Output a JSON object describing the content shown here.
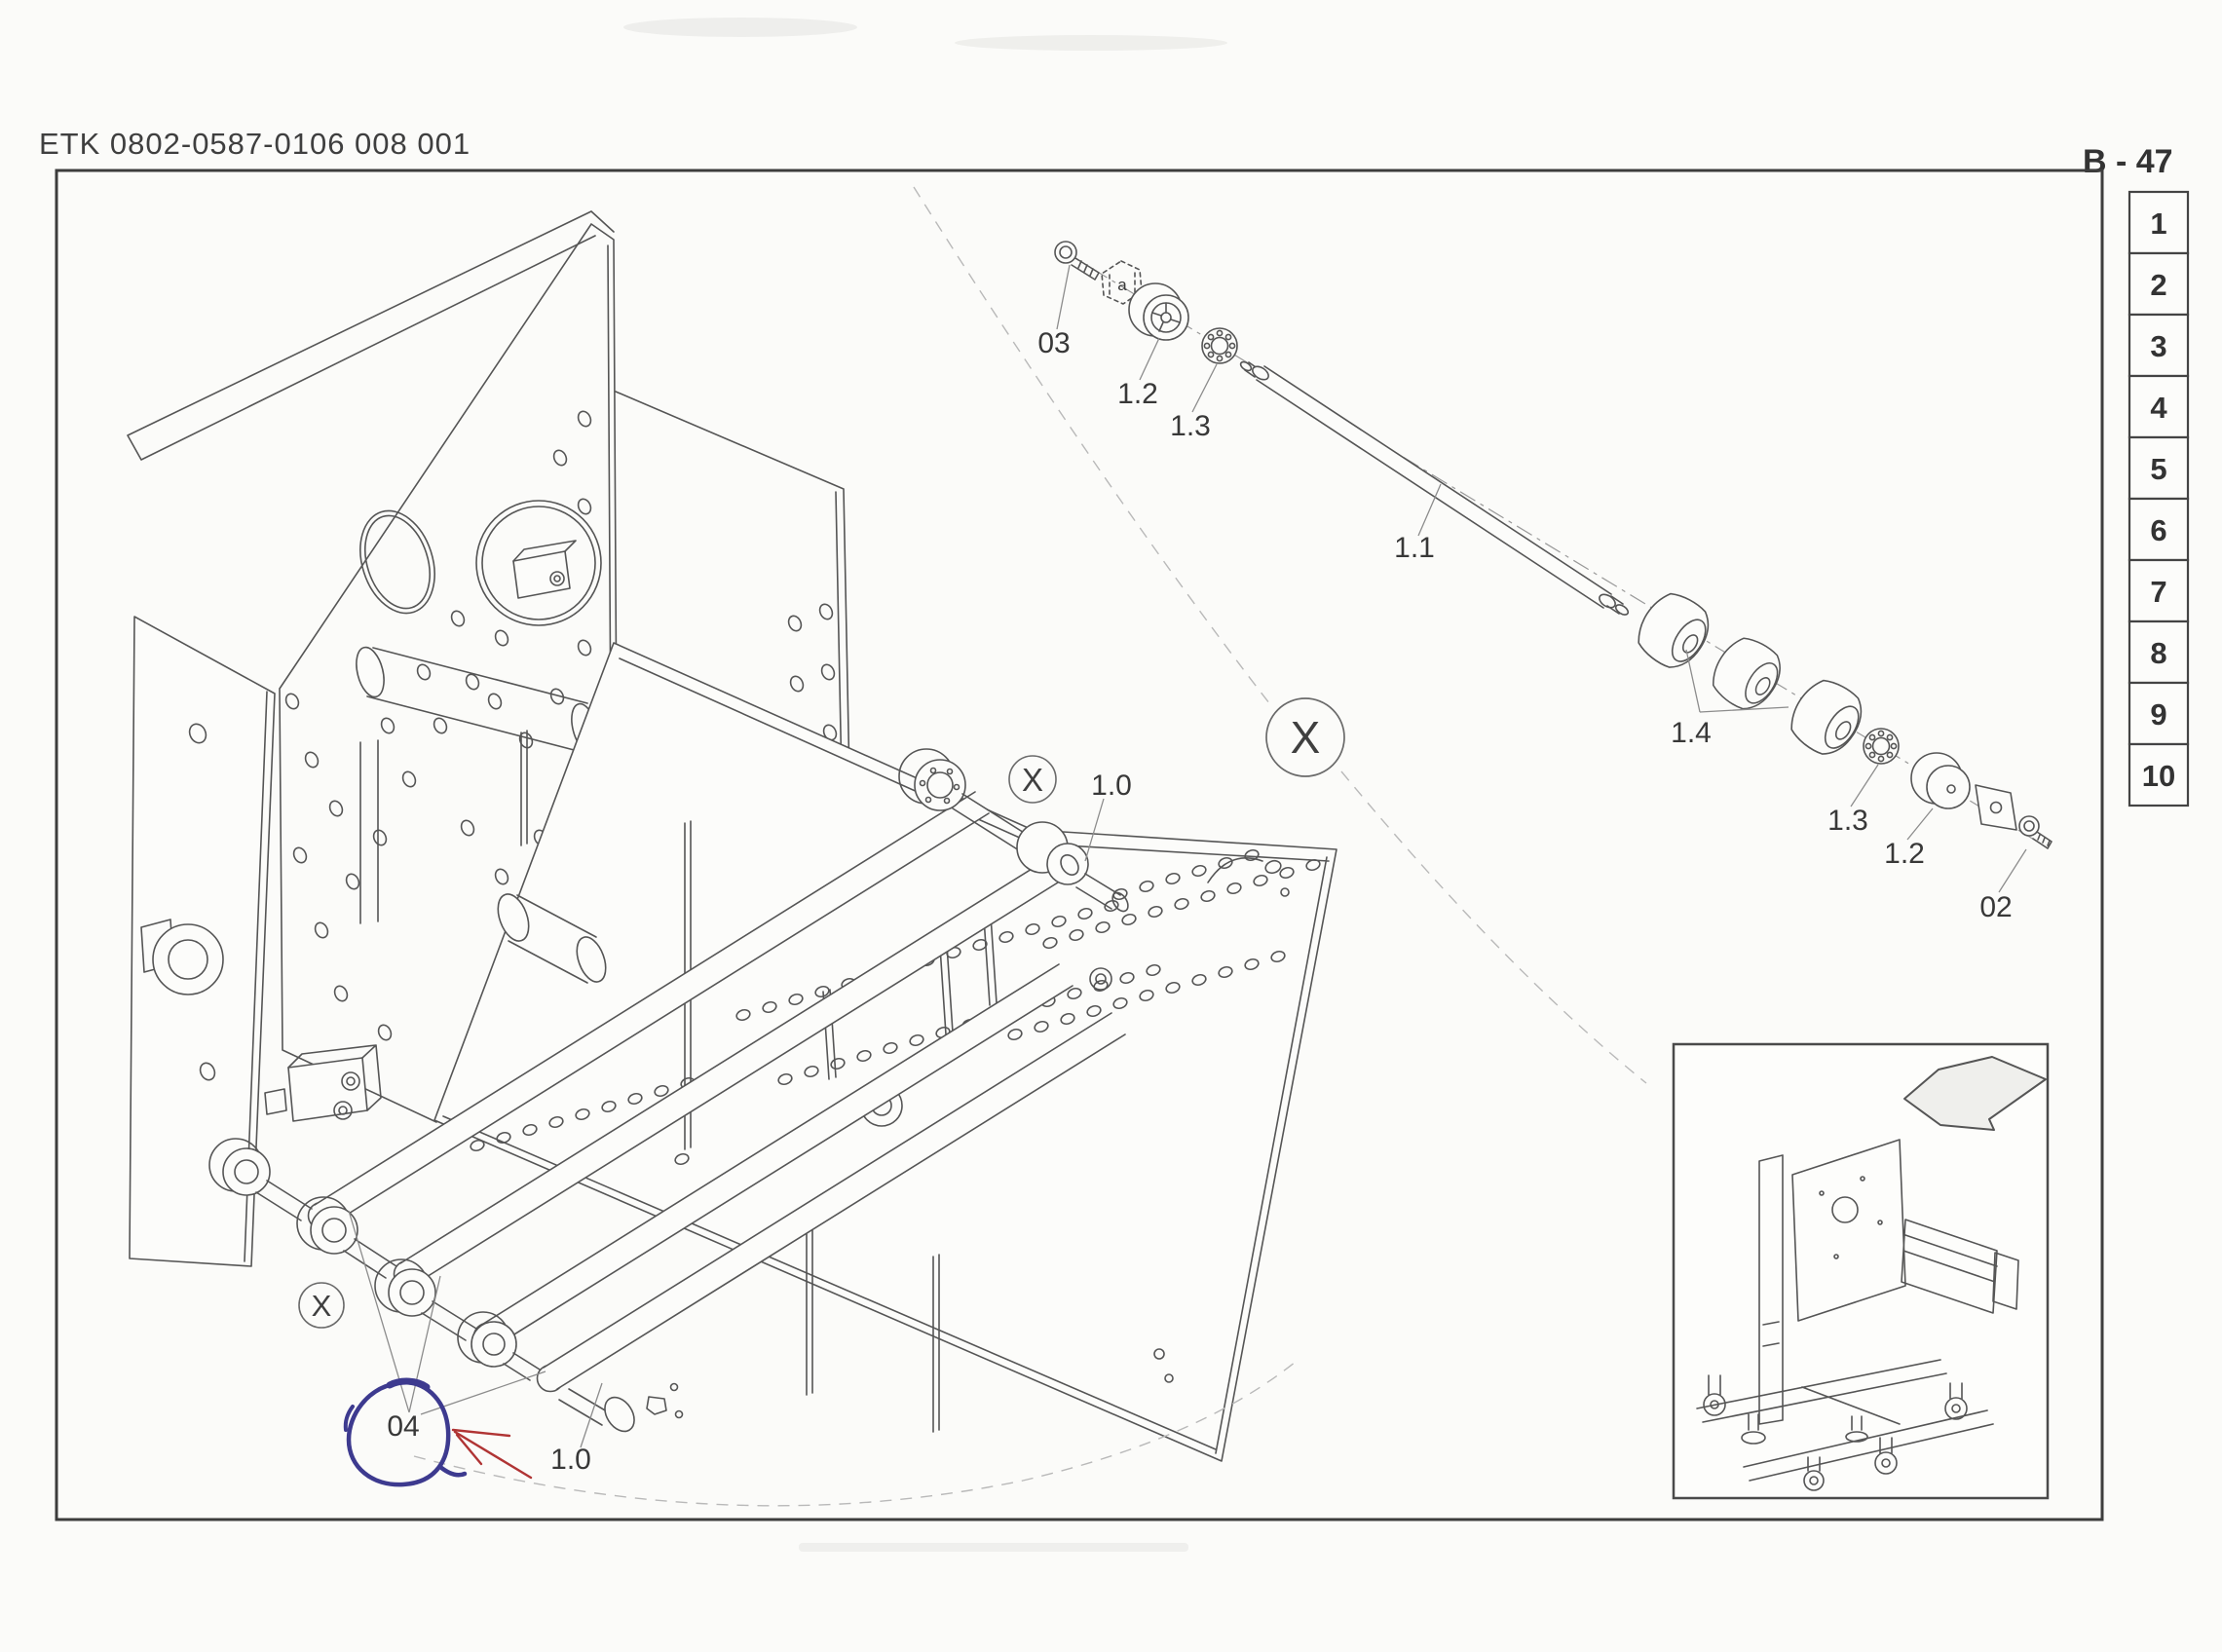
{
  "page": {
    "header_code": "ETK 0802-0587-0106 008 001",
    "page_ref": "B - 47"
  },
  "index_column": {
    "items": [
      "1",
      "2",
      "3",
      "4",
      "5",
      "6",
      "7",
      "8",
      "9",
      "10"
    ]
  },
  "exploded_view": {
    "part_labels": [
      {
        "id": "pos-03",
        "text": "03"
      },
      {
        "id": "roller-upper",
        "text": "1.2"
      },
      {
        "id": "bearing-upper",
        "text": "1.3"
      },
      {
        "id": "shaft",
        "text": "1.1"
      },
      {
        "id": "barrel-rollers",
        "text": "1.4"
      },
      {
        "id": "bearing-lower",
        "text": "1.3"
      },
      {
        "id": "roller-lower",
        "text": "1.2"
      },
      {
        "id": "pos-02",
        "text": "02"
      }
    ],
    "nut_marking": "a"
  },
  "main_view": {
    "assembly_labels": [
      {
        "id": "assembly-upper",
        "text": "1.0"
      },
      {
        "id": "assembly-lower",
        "text": "1.0"
      }
    ],
    "detail_markers": [
      {
        "id": "detail-x-large",
        "text": "X"
      },
      {
        "id": "detail-x-upper",
        "text": "X"
      },
      {
        "id": "detail-x-lower",
        "text": "X"
      }
    ]
  },
  "annotation": {
    "circled_part": "04",
    "circle_color": "#3d3a8f",
    "arrow_color": "#b03434"
  }
}
